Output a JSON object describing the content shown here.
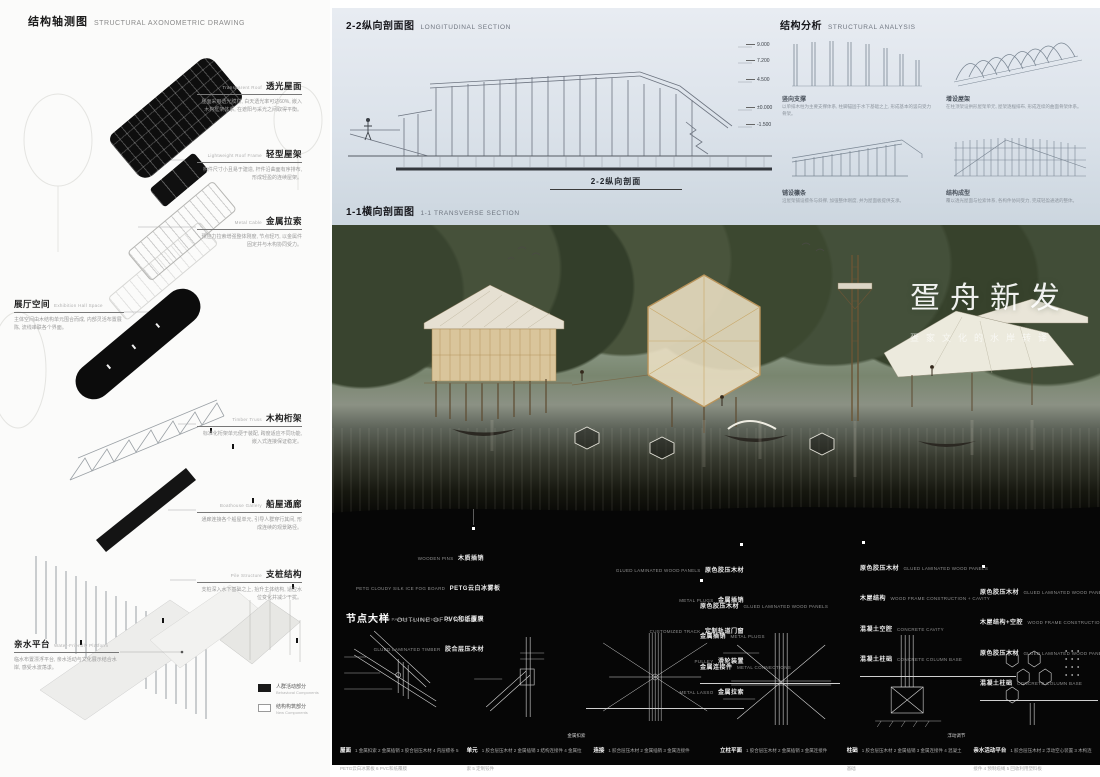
{
  "colors": {
    "band_black": "#060606",
    "sky": "#d8dfe7",
    "wood": "#c9a76f",
    "title_white": "#ffffff"
  },
  "left_panel": {
    "title_zh": "结构轴测图",
    "title_en": "STRUCTURAL AXONOMETRIC DRAWING",
    "annotations": [
      {
        "zh": "透光屋面",
        "en": "Transparent Roof",
        "desc": "屋面采用透光膜材, 白天透光率可达60%, 嵌入木构框架体系, 在遮阳与采光之间取得平衡。"
      },
      {
        "zh": "轻型屋架",
        "en": "Lightweight Roof Frame",
        "desc": "构件尺寸小且易于建造, 杆件沿曲面有序排布, 形成轻盈的连续屋架。"
      },
      {
        "zh": "金属拉索",
        "en": "Metal Cable",
        "desc": "预应力拉索增强整体刚度, 节点轻巧, 以金属件固定并与木构协同受力。"
      },
      {
        "zh": "展厅空间",
        "en": "Exhibition Hall Space",
        "desc": "主体空间由木结构单元围合而成, 内部灵活布置展陈, 流线串联各个界面。"
      },
      {
        "zh": "木构桁架",
        "en": "Timber Truss",
        "desc": "标准化桁架单元便于装配, 跨度适应不同功能, 嵌入式连接保证稳定。"
      },
      {
        "zh": "船屋通廊",
        "en": "Boathouse Gallery",
        "desc": "通廊连接各个船屋单元, 引导人群穿行其间, 形成连续的观景路径。"
      },
      {
        "zh": "支桩结构",
        "en": "Pile Structure",
        "desc": "支桩深入水下基础之上, 抬升主体结构, 适应水位变化并减少干扰。"
      },
      {
        "zh": "亲水平台",
        "en": "Water-Friendly Platform",
        "desc": "临水布置漂浮平台, 亲水活动与文化展示结合水岸, 感受水波荡漾。"
      }
    ],
    "legend": [
      {
        "zh": "人群活动部分",
        "en": "Behavioral Components"
      },
      {
        "zh": "结构构筑部分",
        "en": "New Components"
      }
    ]
  },
  "sections": {
    "longitudinal": {
      "title_zh": "2-2纵向剖面图",
      "title_en": "LONGITUDINAL SECTION",
      "caption": "2-2纵向剖面",
      "elevations": [
        "9.000",
        "7.200",
        "4.500",
        "±0.000",
        "-1.500"
      ]
    },
    "transverse": {
      "title_zh": "1-1横向剖面图",
      "title_en": "1-1 TRANSVERSE SECTION"
    }
  },
  "structural_analysis": {
    "title_zh": "结构分析",
    "title_en": "STRUCTURAL ANALYSIS",
    "steps": [
      {
        "label": "竖向支撑",
        "desc": "以单排木柱为主要支撑体系, 柱脚锚固于水下基础之上, 形成基本的竖向受力骨架。"
      },
      {
        "label": "增设屋架",
        "desc": "在柱顶架设拱形屋架单元, 屋架逐榀排布, 形成连续的曲面骨架体系。"
      },
      {
        "label": "铺设檩条",
        "desc": "沿屋架铺设檩条与斜撑, 加强整体刚度, 并为屋面板提供支承。"
      },
      {
        "label": "结构成型",
        "desc": "覆以透光屋面与拉索体系, 各构件协同受力, 完成轻盈通透的整体。"
      }
    ]
  },
  "hero": {
    "title": "疍舟新发",
    "subtitle": "疍家文化的水岸转译"
  },
  "materials": {
    "blocks": [
      {
        "lines": [
          {
            "en": "WOODEN PINS",
            "zh": "木质插销"
          },
          {
            "en": "PETG CLOUDY SILK ICE FOG BOARD",
            "zh": "PETG云白冰雾板"
          },
          {
            "en": "PVC AND PAPER LAMINATION",
            "zh": "PVC和纸覆膜"
          },
          {
            "en": "GLUED LAMINATED TIMBER",
            "zh": "胶合层压木材"
          }
        ]
      },
      {
        "lines": [
          {
            "en": "GLUED LAMINATED WOOD PANELS",
            "zh": "原色胶压木材"
          },
          {
            "en": "METAL PLUGS",
            "zh": "金属插销"
          },
          {
            "en": "CUSTOMIZED TRACK",
            "zh": "定制轨道门窗"
          },
          {
            "en": "PULLEY",
            "zh": "滑轮装置"
          },
          {
            "en": "METAL LASSO",
            "zh": "金属拉索"
          }
        ]
      },
      {
        "lines": [
          {
            "zh": "原色胶压木材",
            "en": "GLUED LAMINATED WOOD PANELS"
          },
          {
            "zh": "金属插销",
            "en": "METAL PLUGS"
          },
          {
            "zh": "金属连接件",
            "en": "METAL CONNECTIONS"
          }
        ]
      },
      {
        "lines": [
          {
            "zh": "原色胶压木材",
            "en": "GLUED LAMINATED WOOD PANELS"
          },
          {
            "zh": "木屋结构",
            "en": "WOOD FRAME CONSTRUCTION + CAVITY"
          },
          {
            "zh": "混凝土空腔",
            "en": "CONCRETE CAVITY"
          },
          {
            "zh": "混凝土柱础",
            "en": "CONCRETE COLUMN BASE"
          }
        ]
      },
      {
        "lines": [
          {
            "zh": "原色胶压木材",
            "en": "GLUED LAMINATED WOOD PANELS"
          },
          {
            "zh": "木屋结构+空腔",
            "en": "WOOD FRAME CONSTRUCTION + CAVITY"
          },
          {
            "zh": "原色胶压木材",
            "en": "GLUED LAMINATED WOOD PANELS"
          },
          {
            "zh": "混凝土柱础",
            "en": "CONCRETE COLUMN BASE"
          }
        ]
      }
    ]
  },
  "node_details": {
    "title_zh": "节点大样",
    "title_en": "OUTLINE OF A NODE",
    "details": [
      {
        "name": "屋面",
        "items": [
          "1 金属扣索",
          "2 金属插销",
          "3 胶合层压木材",
          "4 内层檩条",
          "5 PETG云白冰雾板",
          "6 PVC和纸覆膜"
        ]
      },
      {
        "name": "单元",
        "note": "金属扣索",
        "items": [
          "1 胶合层压木材",
          "2 金属插销",
          "3 结构连接件",
          "4 金属拉索",
          "5 定制铰件"
        ]
      },
      {
        "name": "连接",
        "items": [
          "1 胶合层压木材",
          "2 金属插销",
          "3 金属连接件"
        ]
      },
      {
        "name": "立柱平面",
        "items": [
          "1 胶合层压木材",
          "2 金属插销",
          "3 金属连接件"
        ]
      },
      {
        "name": "柱础",
        "note": "浮动调节",
        "items": [
          "1 胶合层压木材",
          "2 金属插销",
          "3 金属连接件",
          "4 混凝土基础"
        ]
      },
      {
        "name": "亲水活动平台",
        "items": [
          "1 胶合层压木材",
          "2 浮动空心装置",
          "3 木构连接件",
          "4 预制缆绳",
          "5 回收利用塑料板"
        ]
      }
    ]
  }
}
